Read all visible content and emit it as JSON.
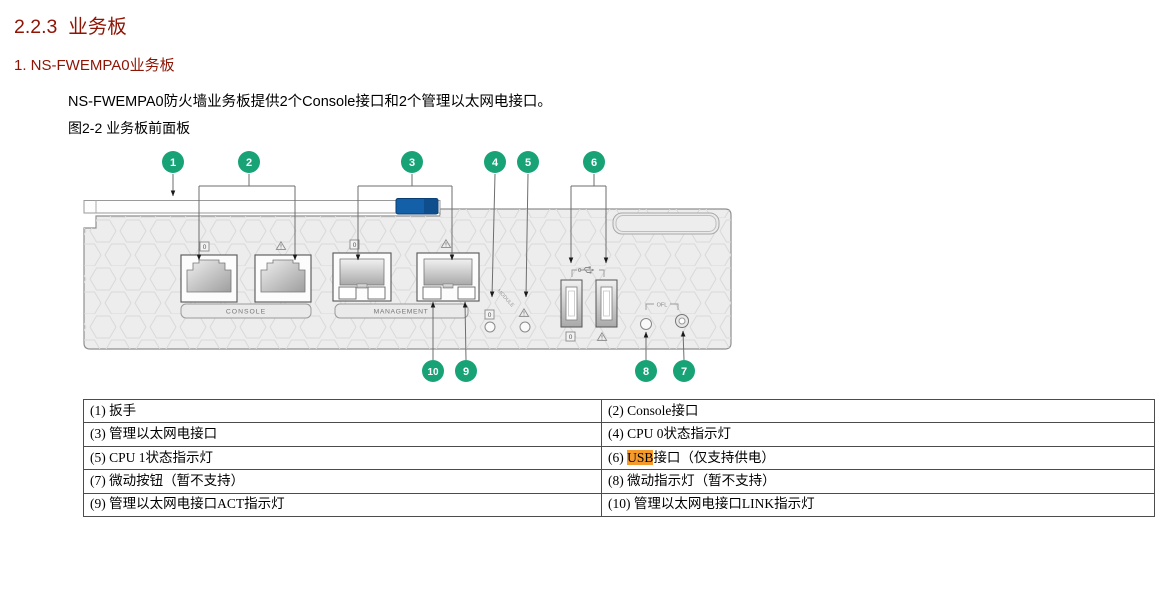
{
  "page": {
    "section_heading": "2.2.3  业务板",
    "subsection_heading": "1. NS-FWEMPA0业务板",
    "body_text": "NS-FWEMPA0防火墙业务板提供2个Console接口和2个管理以太网电接口。",
    "figure_caption": "图2-2 业务板前面板"
  },
  "figure": {
    "callouts": [
      "1",
      "2",
      "3",
      "4",
      "5",
      "6",
      "7",
      "8",
      "9",
      "10"
    ],
    "labels": {
      "console": "CONSOLE",
      "management": "MANAGEMENT",
      "ofl": "OFL",
      "module": "MODULE",
      "zero": "0"
    }
  },
  "table": {
    "rows": [
      {
        "left": [
          {
            "text": "(1) 扳手"
          }
        ],
        "right": [
          {
            "text": "(2) Console接口"
          }
        ]
      },
      {
        "left": [
          {
            "text": "(3) 管理以太网电接口"
          }
        ],
        "right": [
          {
            "text": "(4) CPU 0状态指示灯"
          }
        ]
      },
      {
        "left": [
          {
            "text": "(5) CPU 1状态指示灯"
          }
        ],
        "right": [
          {
            "text": "(6) "
          },
          {
            "text": "USB",
            "highlight": true
          },
          {
            "text": "接口（仅支持供电）"
          }
        ]
      },
      {
        "left": [
          {
            "text": "(7) 微动按钮（暂不支持）"
          }
        ],
        "right": [
          {
            "text": "(8) 微动指示灯（暂不支持）"
          }
        ]
      },
      {
        "left": [
          {
            "text": "(9) 管理以太网电接口ACT指示灯"
          }
        ],
        "right": [
          {
            "text": "(10) 管理以太网电接口LINK指示灯"
          }
        ]
      }
    ]
  },
  "colors": {
    "heading_red": "#8E1404",
    "callout_green": "#18A377",
    "highlight_orange": "#F59B2C",
    "latch_blue": "#1460A8"
  }
}
